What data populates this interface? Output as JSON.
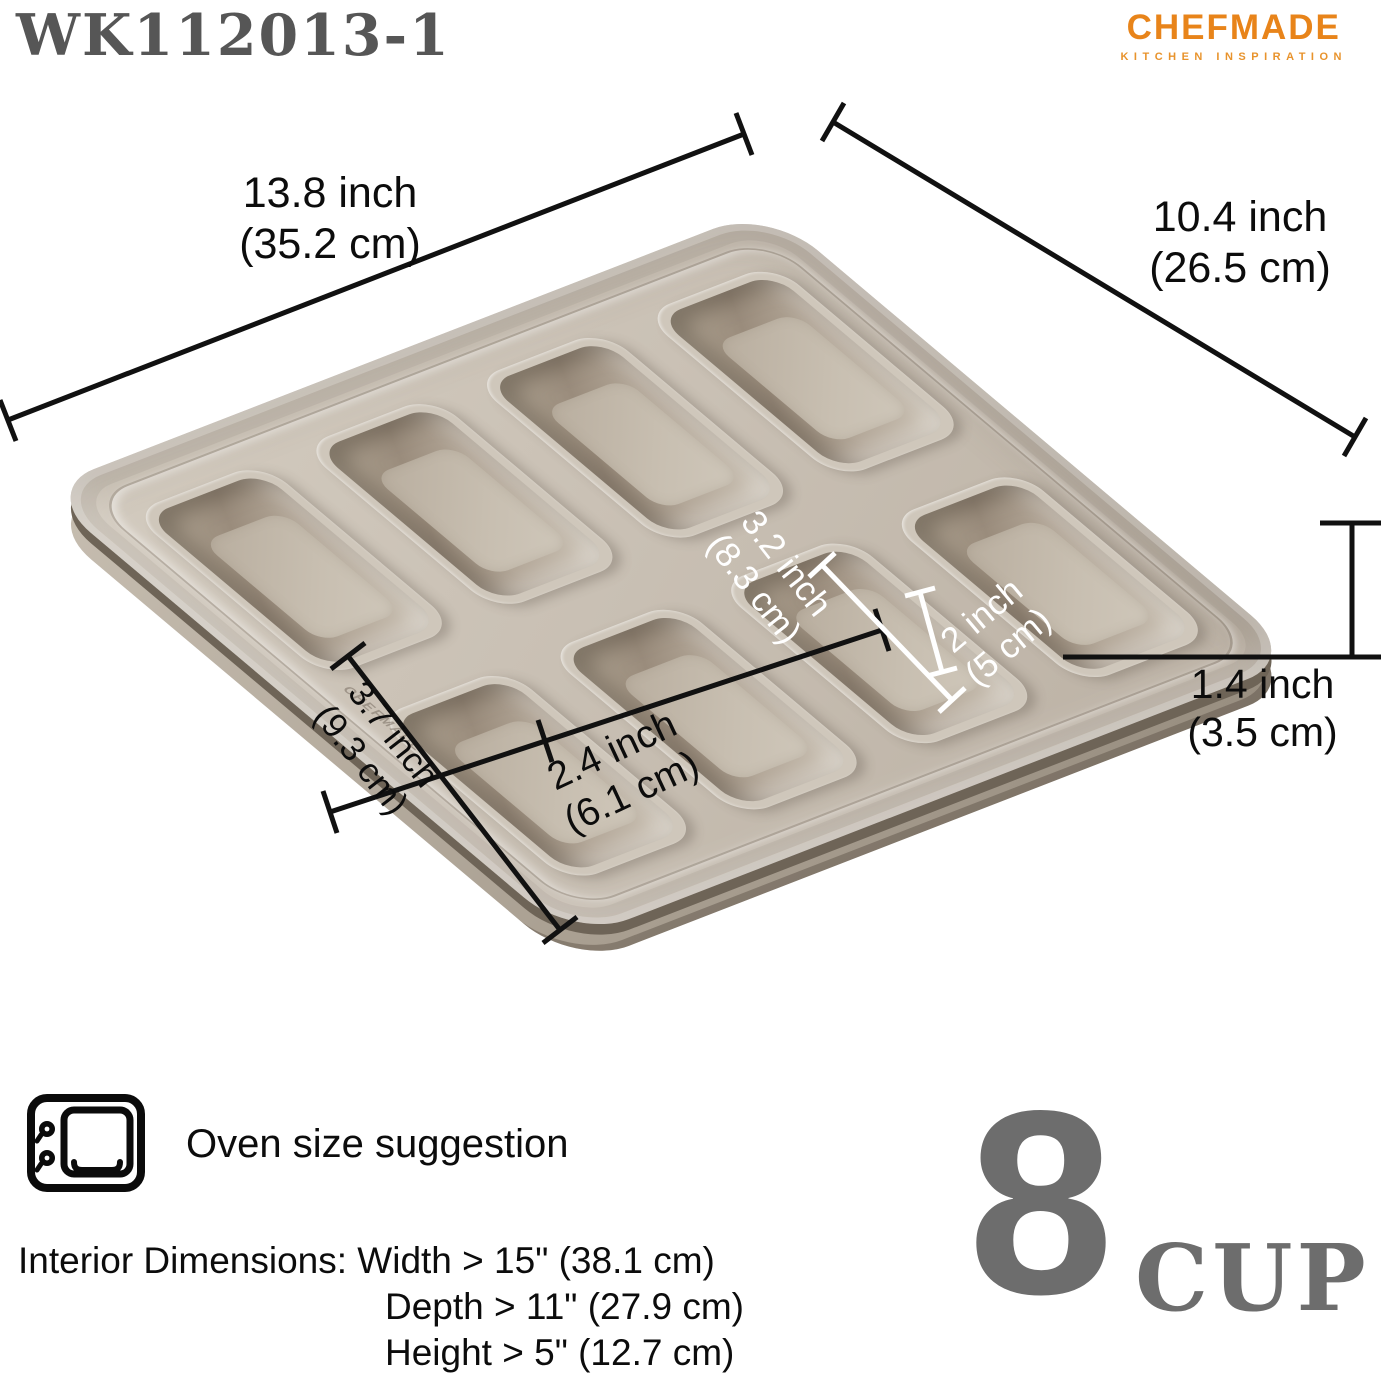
{
  "header": {
    "model": "WK112013-1",
    "brand": "CHEFMADE",
    "brand_tagline": "KITCHEN INSPIRATION"
  },
  "colors": {
    "brand_orange": "#E8841A",
    "model_gray": "#565656",
    "cup_gray": "#6D6D6D",
    "pan_surface": "#C9C0B4",
    "pan_cavity_shadow": "#9A8C7C",
    "annotation_black": "#0C0C0C",
    "annotation_white": "#FFFFFF"
  },
  "pan": {
    "embossed_brand": "CHEFMADE",
    "cavity_count": "8"
  },
  "dimensions": {
    "length": {
      "line1": "13.8 inch",
      "line2": "(35.2 cm)"
    },
    "width": {
      "line1": "10.4 inch",
      "line2": "(26.5 cm)"
    },
    "height": {
      "line1": "1.4 inch",
      "line2": "(3.5 cm)"
    },
    "cavity_length": {
      "line1": "3.7 inch",
      "line2": "(9.3 cm)"
    },
    "cavity_width": {
      "line1": "2.4 inch",
      "line2": "(6.1 cm)"
    },
    "cavity_inner_length": {
      "line1": "3.2 inch",
      "line2": "(8.3 cm)"
    },
    "cavity_inner_width": {
      "line1": "2 inch",
      "line2": "(5 cm)"
    }
  },
  "oven": {
    "label": "Oven size suggestion",
    "interior_intro": "Interior Dimensions:",
    "width_spec": "Width > 15\"  (38.1 cm)",
    "depth_spec": "Depth > 11\" (27.9 cm)",
    "height_spec": "Height > 5\" (12.7 cm)"
  },
  "capacity": {
    "number": "8",
    "unit": "CUP"
  }
}
